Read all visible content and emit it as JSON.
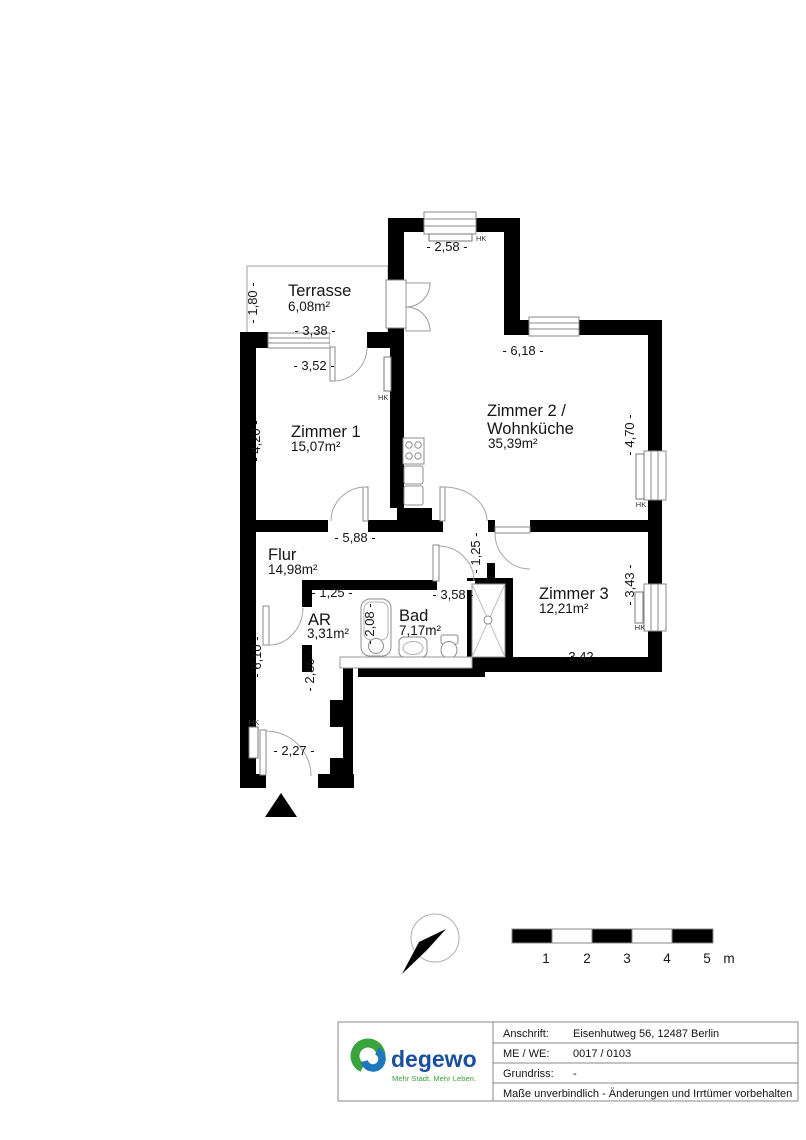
{
  "plan": {
    "rooms": {
      "terrasse": {
        "name": "Terrasse",
        "area": "6,08m²"
      },
      "zimmer1": {
        "name": "Zimmer 1",
        "area": "15,07m²"
      },
      "zimmer2": {
        "name_line1": "Zimmer 2 /",
        "name_line2": "Wohnküche",
        "area": "35,39m²"
      },
      "flur": {
        "name": "Flur",
        "area": "14,98m²"
      },
      "ar": {
        "name": "AR",
        "area": "3,31m²"
      },
      "bad": {
        "name": "Bad",
        "area": "7,17m²"
      },
      "zimmer3": {
        "name": "Zimmer 3",
        "area": "12,21m²"
      }
    },
    "dimensions": {
      "terrasse_depth": "- 1,80 -",
      "terrasse_width": "- 3,38 -",
      "top_width": "- 2,58 -",
      "zimmer1_width": "- 3,52 -",
      "zimmer1_depth": "- 4,20 -",
      "zimmer2_width": "- 6,18 -",
      "zimmer2_depth": "- 4,70 -",
      "flur_width": "- 5,88 -",
      "ar_width": "- 1,25 -",
      "nook_width": "- 1,25 -",
      "bad_width": "- 3,58 -",
      "bad_depth": "- 2,08 -",
      "corridor_upper": "- 2,86 -",
      "corridor_depth": "- 6,10 -",
      "zimmer3_depth": "- 3,43 -",
      "zimmer3_width": "- 3,42 -",
      "entrance_width": "- 2,27 -"
    },
    "radiator_label": "HK"
  },
  "scale_bar": {
    "ticks": [
      "1",
      "2",
      "3",
      "4",
      "5"
    ],
    "unit": "m"
  },
  "title_block": {
    "rows": [
      {
        "label": "Anschrift:",
        "value": "Eisenhutweg 56, 12487 Berlin"
      },
      {
        "label": "ME / WE:",
        "value": "0017 / 0103"
      },
      {
        "label": "Grundriss:",
        "value": "-"
      }
    ],
    "note": "Maße unverbindlich - Änderungen und Irrtümer vorbehalten"
  },
  "logo": {
    "brand": "degewo",
    "tagline": "Mehr Stadt. Mehr Leben."
  }
}
